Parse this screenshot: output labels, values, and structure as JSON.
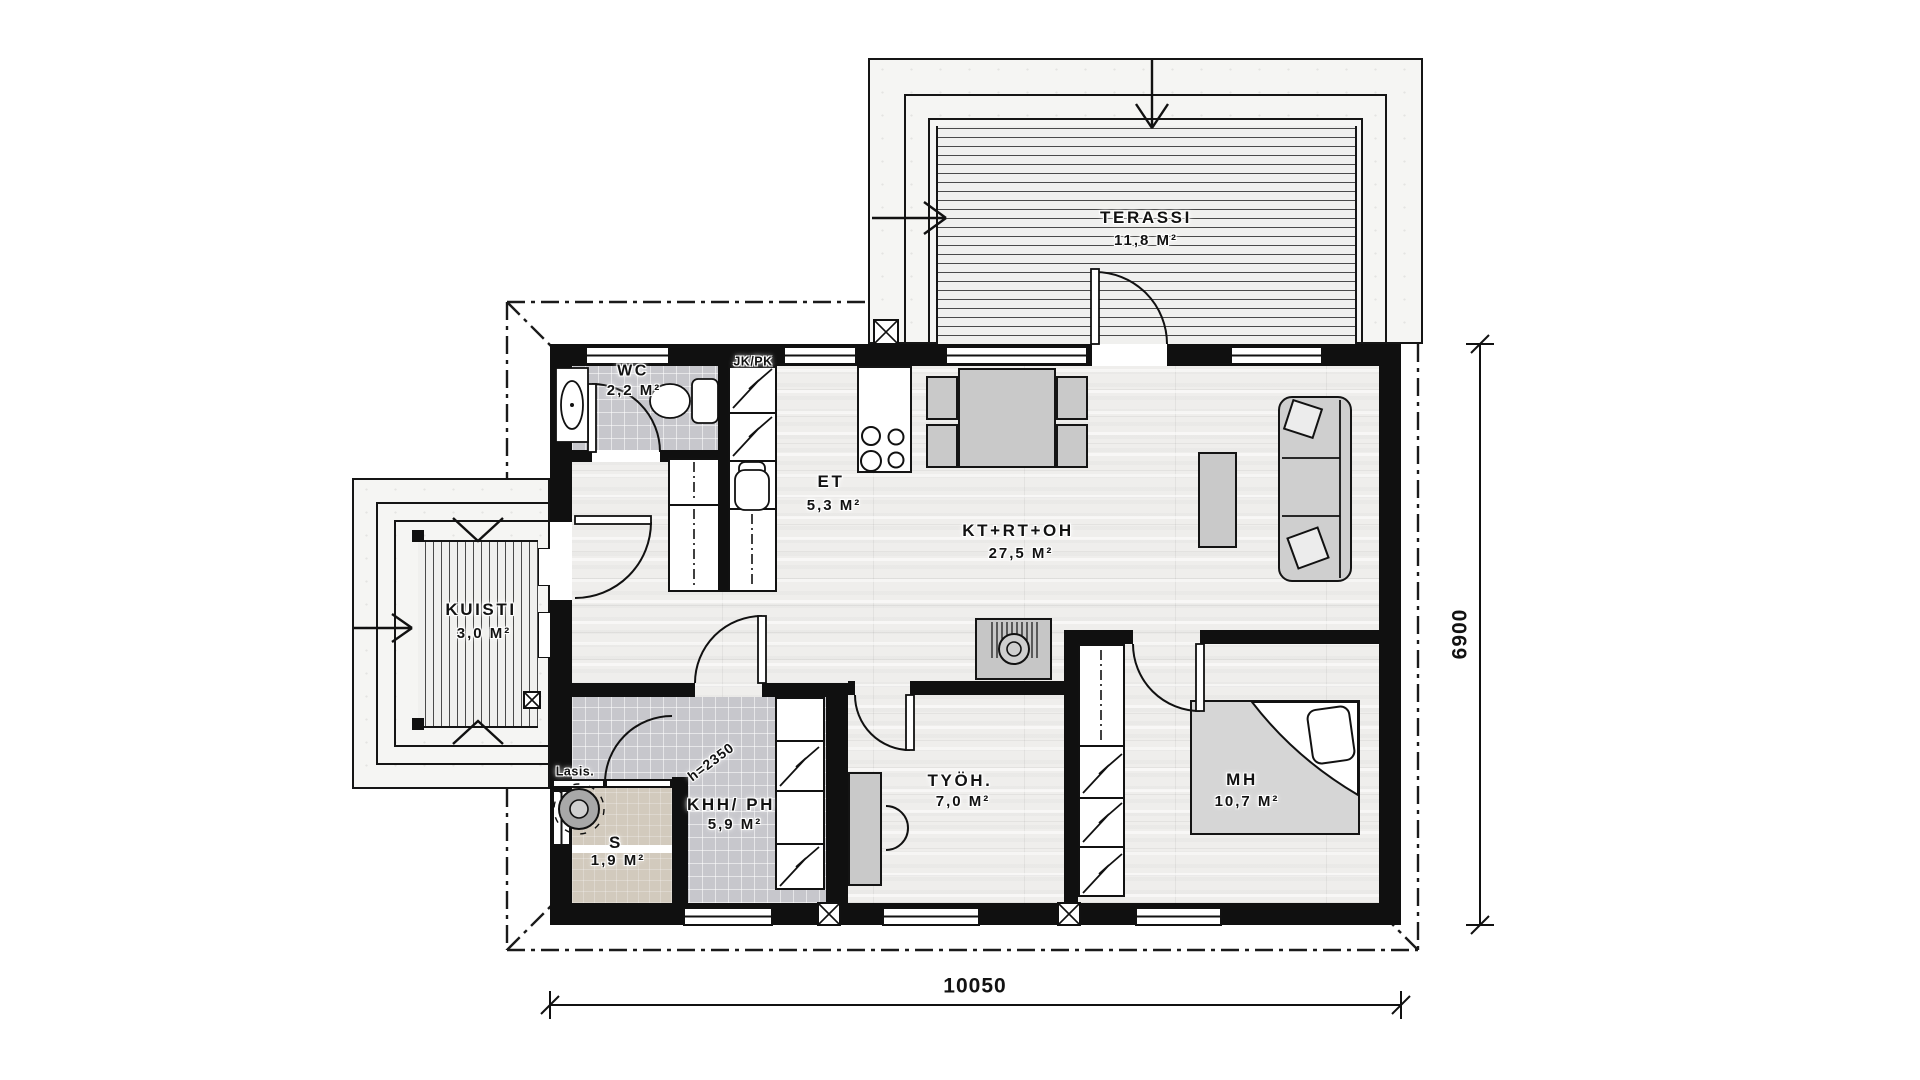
{
  "plan": {
    "type": "floor-plan",
    "rooms": [
      {
        "id": "terassi",
        "label": "TERASSI",
        "area": "11,8 m²"
      },
      {
        "id": "wc",
        "label": "WC",
        "area": "2,2 m²"
      },
      {
        "id": "kuisti",
        "label": "KUISTI",
        "area": "3,0 m²"
      },
      {
        "id": "et",
        "label": "ET",
        "area": "5,3 m²"
      },
      {
        "id": "kt_rt_oh",
        "label": "KT+RT+OH",
        "area": "27,5 m²"
      },
      {
        "id": "khh_ph",
        "label": "KHH/ PH",
        "area": "5,9 m²"
      },
      {
        "id": "s",
        "label": "S",
        "area": "1,9 m²"
      },
      {
        "id": "tyoh",
        "label": "TYÖH.",
        "area": "7,0 m²"
      },
      {
        "id": "mh",
        "label": "MH",
        "area": "10,7 m²"
      }
    ],
    "annotations": {
      "fridge_freezer": "JK/PK",
      "glass_wall": "Lasis.",
      "ceiling_height": "h=2350"
    },
    "dimensions": {
      "overall_width_mm": "10050",
      "overall_height_mm": "6900"
    },
    "colors": {
      "wall": "#101010",
      "tile_floor": "#c7c7cc",
      "wood_floor": "#efeeec",
      "sauna_floor": "#d2cabd",
      "furniture": "#c9c9c9",
      "background": "#ffffff"
    }
  }
}
